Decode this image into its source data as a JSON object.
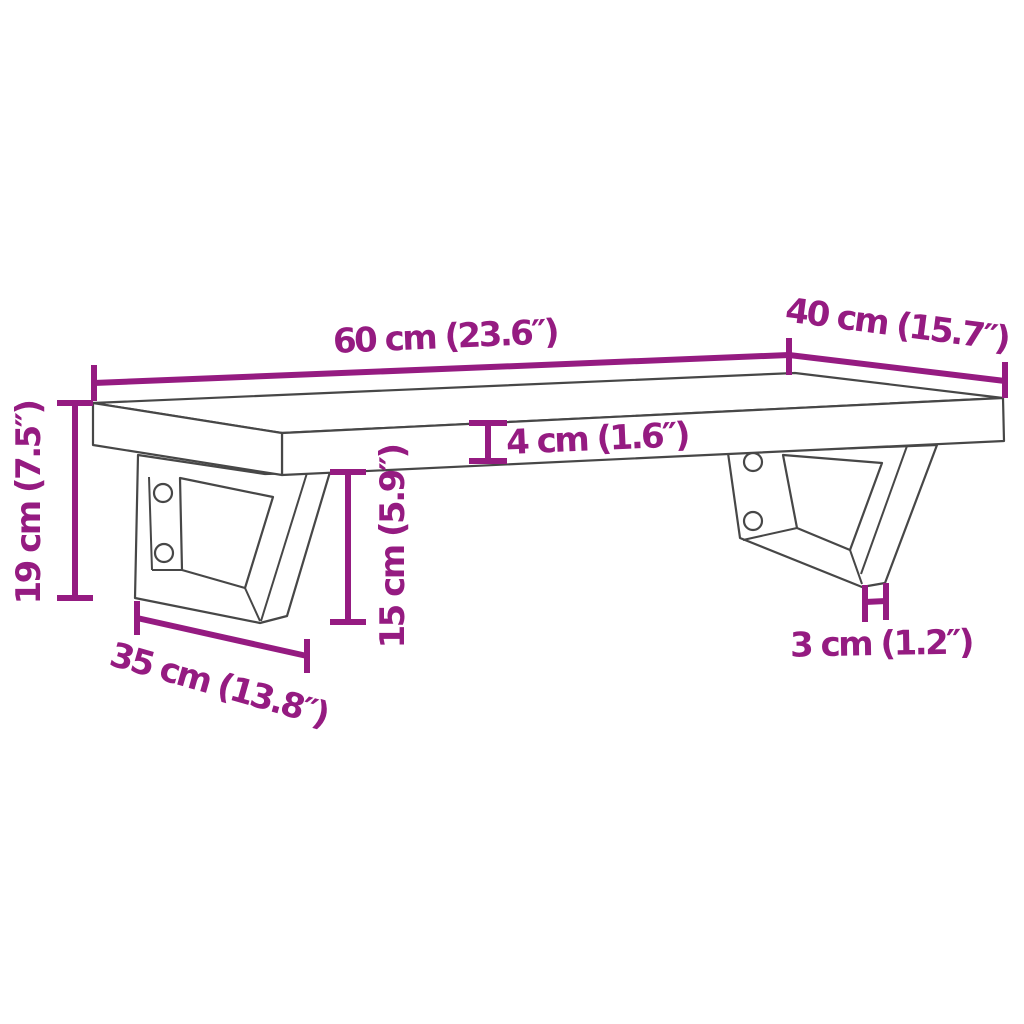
{
  "diagram": {
    "background_color": "#FFFFFF",
    "dimension_color": "#951B81",
    "outline_color": "#474747",
    "labels": {
      "width": "60 cm (23.6″)",
      "depth": "40 cm (15.7″)",
      "shelf_thickness": "4 cm (1.6″)",
      "overall_height": "19 cm (7.5″)",
      "bracket_height": "15 cm (5.9″)",
      "bracket_depth": "35 cm (13.8″)",
      "bracket_foot": "3 cm (1.2″)"
    }
  }
}
